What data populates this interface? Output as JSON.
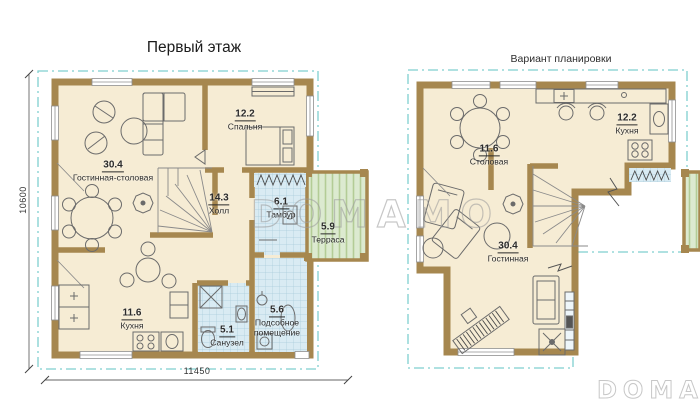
{
  "plans": [
    {
      "title": "Первый этаж",
      "rooms": [
        {
          "area": "30.4",
          "name": "Гостинная-столовая"
        },
        {
          "area": "12.2",
          "name": "Спальня"
        },
        {
          "area": "14.3",
          "name": "Холл"
        },
        {
          "area": "6.1",
          "name": "Тамбур"
        },
        {
          "area": "5.9",
          "name": "Терраса"
        },
        {
          "area": "11.6",
          "name": "Кухня"
        },
        {
          "area": "5.1",
          "name": "Санузел"
        },
        {
          "area": "5.6",
          "name": "Подсобное помещение"
        }
      ]
    },
    {
      "title": "Вариант планировки",
      "rooms": [
        {
          "area": "11.6",
          "name": "Столовая"
        },
        {
          "area": "12.2",
          "name": "Кухня"
        },
        {
          "area": "30.4",
          "name": "Гостинная"
        }
      ]
    }
  ],
  "dimensions": {
    "height": "10600",
    "width": "11450"
  },
  "watermarks": {
    "center": "DOMAMO",
    "corner": "DOMAMO"
  },
  "colors": {
    "wall": "#a6874f",
    "floor": "#f6ecd4",
    "tile": "#d9ebf3",
    "tile_line": "#a9cbdb",
    "terrace": "#dcead0",
    "terrace_line": "#b3cc96",
    "roof_outline": "#7fcfcf",
    "text": "#2b2b2b",
    "watermark": "#9a9a9a",
    "dimension": "#666666"
  }
}
